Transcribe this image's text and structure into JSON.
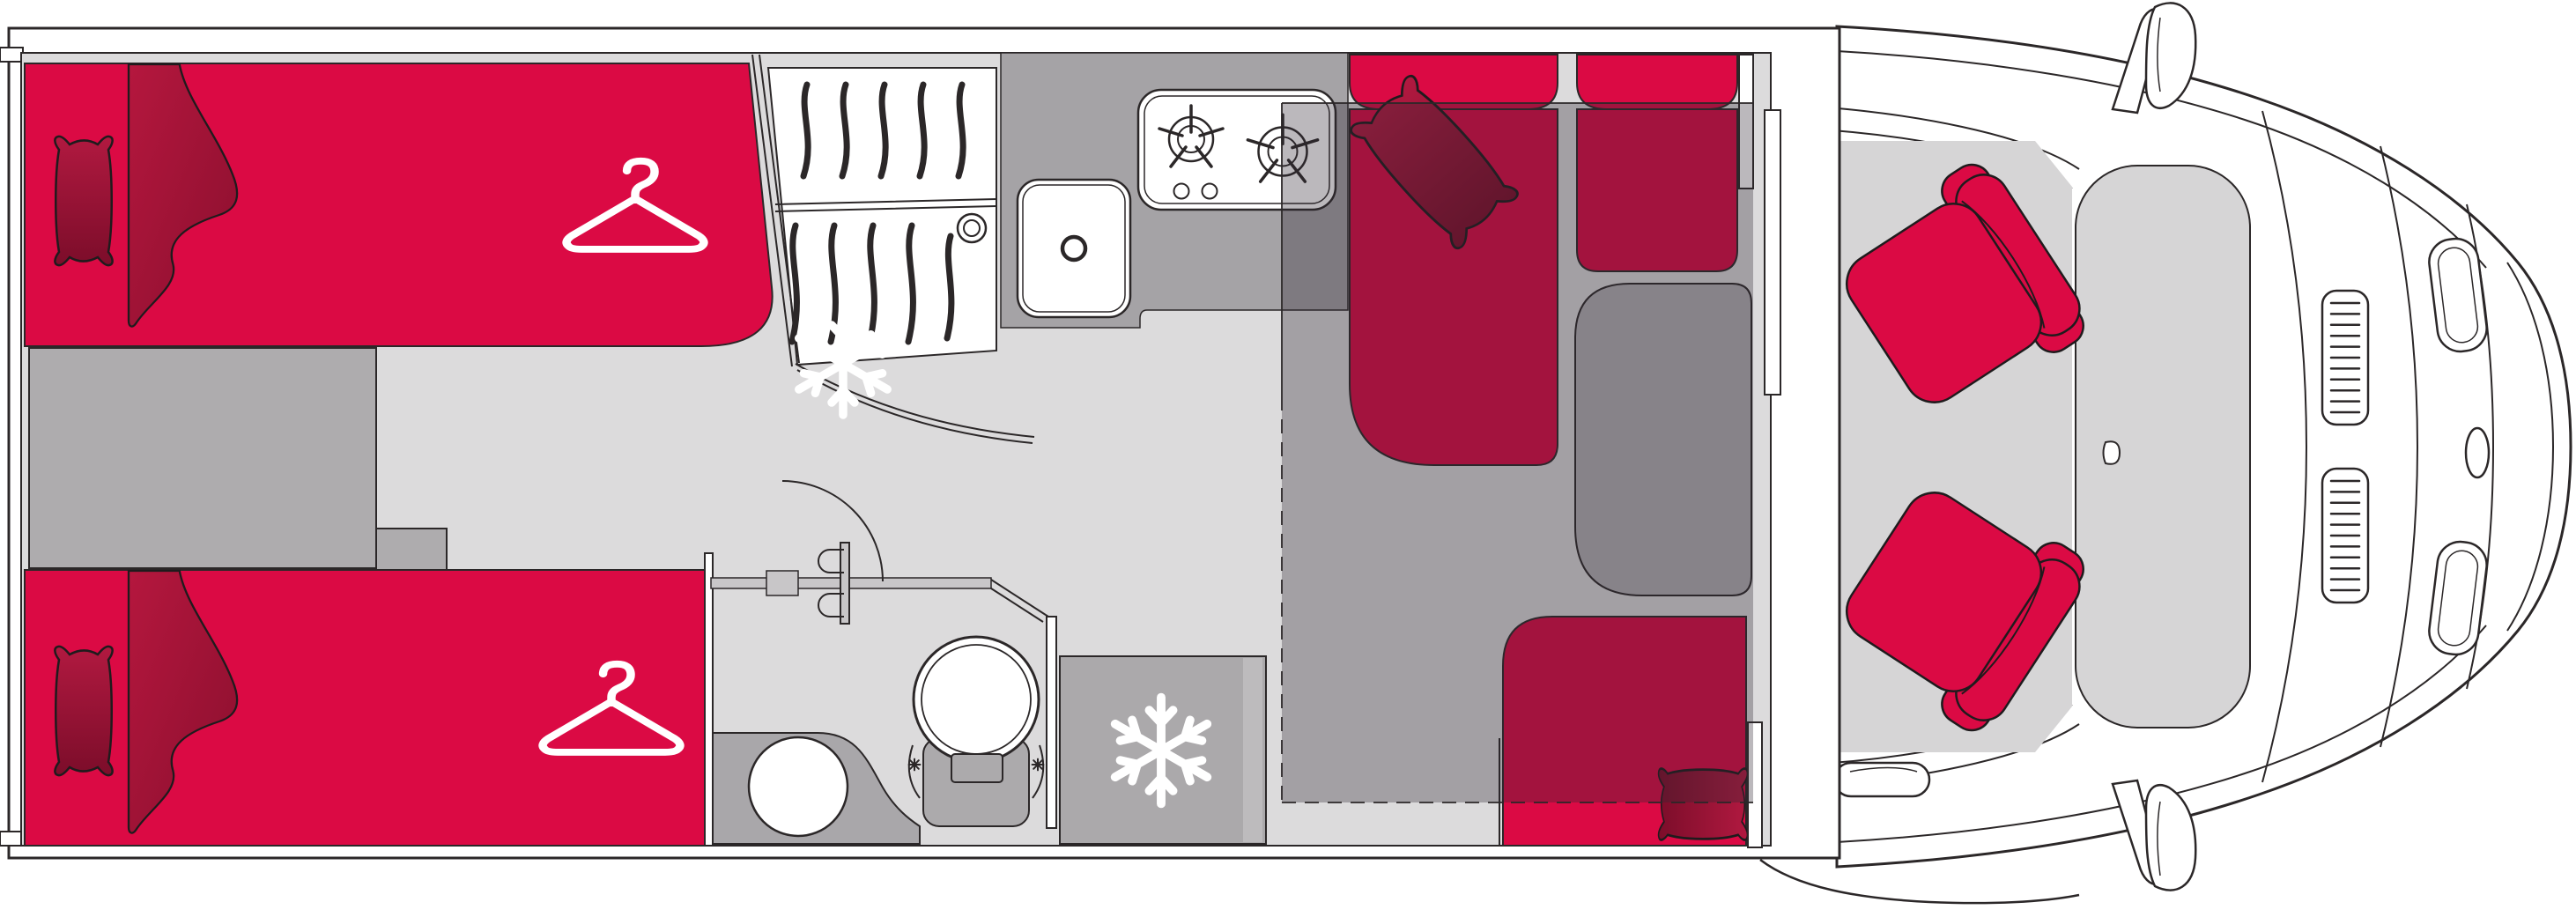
{
  "diagram_type": "motorhome floor plan, top view, cab on right",
  "colors": {
    "bed_red": "#DB0A44",
    "cushion_red_dark": "#9A1134",
    "floor": "#DCDBDC",
    "wall": "#FFFFFF",
    "outline": "#2B2728",
    "cabinet_gray": "#AEACAE",
    "counter_gray": "#A5A3A6",
    "fridge_gray": "#ABA9AB",
    "table_gray": "#B2B0B4",
    "glass_gray": "#D6D5D6",
    "bath_counter_gray": "#A9A7AA",
    "door_gray": "#C8C6C8",
    "overlay": "rgba(50,38,52,0.33)",
    "icon_white": "#FFFFFF"
  },
  "floorplan": {
    "rooms": [
      {
        "name": "bedroom",
        "features": [
          "twin bed top",
          "twin bed bottom",
          "bedside cabinet",
          "foot step",
          "pillow on each bed",
          "throw blanket on each bed",
          "white hanger symbol on each bed"
        ]
      },
      {
        "name": "shower and wardrobe",
        "features": [
          "slanted partition wall",
          "hanging clothes shown as wavy strokes in two panels",
          "round knob",
          "curved shower tray edge",
          "door swing arc",
          "folding door track",
          "white snowflake symbol"
        ]
      },
      {
        "name": "kitchen",
        "features": [
          "L-shaped worktop",
          "rectangular sink with drain",
          "two-burner gas hob with two knobs"
        ]
      },
      {
        "name": "washroom",
        "features": [
          "swivel toilet with round lid",
          "vanity counter with round washbasin",
          "partition walls"
        ]
      },
      {
        "name": "fridge",
        "features": [
          "refrigerator cabinet with white snowflake symbol"
        ]
      },
      {
        "name": "dinette",
        "features": [
          "two backrest cushions on wall",
          "L-shaped sofa",
          "short side sofa",
          "pedestal table with rounded corners",
          "single bench with cushion",
          "translucent drop-down bed overlay with dashed edge"
        ]
      },
      {
        "name": "cab",
        "features": [
          "two red swivel captain seats",
          "windshield",
          "dashboard pillars",
          "two exterior mirrors",
          "two bonnet vent grilles",
          "two headlights",
          "fog light oval",
          "door handle cup",
          "entry step",
          "door handle"
        ]
      }
    ],
    "icons": [
      {
        "name": "hanger-icon",
        "count": 2,
        "color": "#FFFFFF"
      },
      {
        "name": "snowflake-icon",
        "count": 2,
        "color": "#FFFFFF"
      }
    ],
    "counts": {
      "beds": 2,
      "cab_seats": 2,
      "pillows": 4,
      "tables": 1,
      "hob_burners": 2,
      "mirrors": 2,
      "vents": 2
    }
  }
}
